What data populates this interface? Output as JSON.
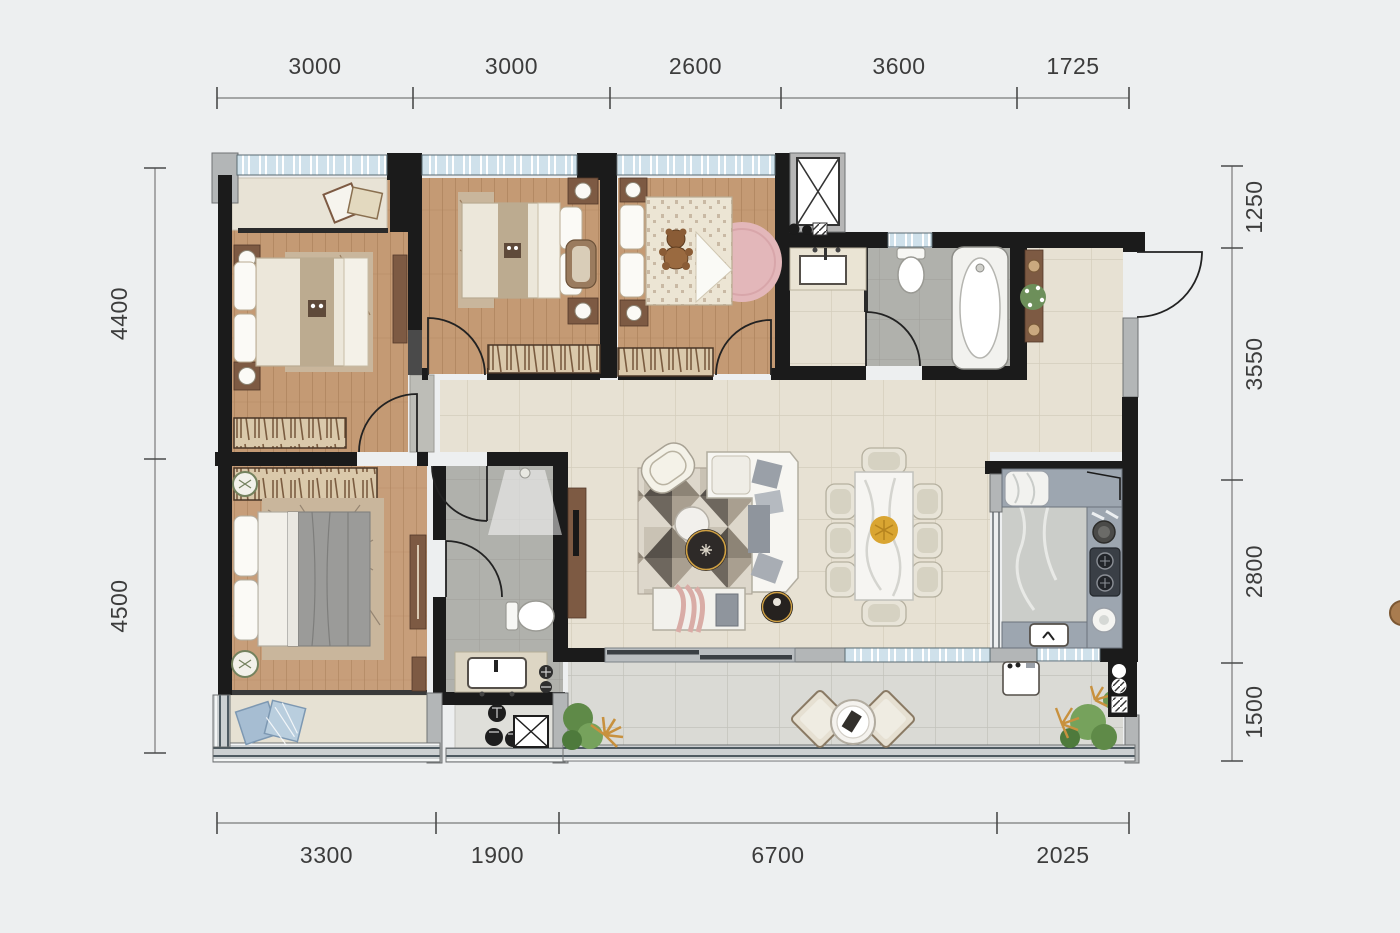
{
  "figure": "residential-floor-plan",
  "dimensions": {
    "top": {
      "orientation": "horizontal",
      "line_y": 98,
      "label_offset": -24,
      "ticks": [
        217,
        413,
        610,
        781,
        1017,
        1129
      ],
      "labels": [
        "3000",
        "3000",
        "2600",
        "3600",
        "1725"
      ]
    },
    "bottom": {
      "orientation": "horizontal",
      "line_y": 823,
      "label_offset": 40,
      "ticks": [
        217,
        436,
        559,
        997,
        1129
      ],
      "labels": [
        "3300",
        "1900",
        "6700",
        "2025"
      ]
    },
    "left": {
      "orientation": "vertical",
      "line_x": 155,
      "label_offset": -28,
      "ticks": [
        168,
        459,
        753
      ],
      "labels": [
        "4400",
        "4500"
      ]
    },
    "right": {
      "orientation": "vertical",
      "line_x": 1232,
      "label_offset": 30,
      "ticks": [
        166,
        248,
        480,
        663,
        761
      ],
      "labels": [
        "1250",
        "3550",
        "2800",
        "1500"
      ]
    }
  },
  "colors": {
    "background": "#edeff0",
    "wall": "#1b1b1b",
    "pier_gray": "#b3b6b7",
    "wood_floor": "#c49a74",
    "tile_cream": "#e7e1d3",
    "tile_terrace": "#dadad5",
    "tile_bath_gray": "#b0b1ac",
    "window_glass": "#cfe1eb",
    "counter_gray": "#9da6b0",
    "accent_gold": "#cfa043",
    "accent_pink_rug": "#e3b7ba",
    "accent_blue_pillow": "#b9cede",
    "dimension_text": "#3c3c3c"
  }
}
